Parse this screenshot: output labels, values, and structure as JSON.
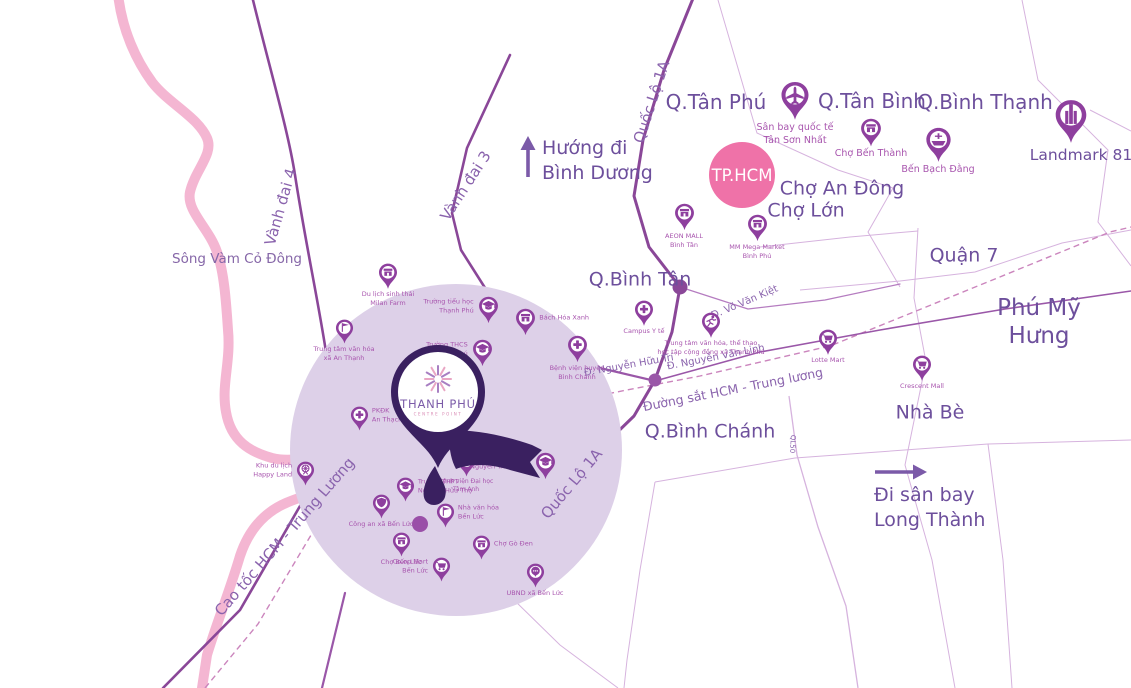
{
  "colors": {
    "road": "#8a4798",
    "road_minor": "#9a57a8",
    "boundary": "#d6b3de",
    "railway": "#cb85bd",
    "river": "#f4b6d2",
    "zone_circle": "#ddd0e8",
    "pin": "#8e3f9e",
    "dark_pin": "#3a2060",
    "hcm_pink": "#ef72a8",
    "label": "#6d4f9c",
    "road_label": "#8a63ad",
    "poi_label": "#a855ae",
    "petal_pink": "#e9a6c4",
    "petal_purple": "#a87fc2",
    "arrow": "#7b5aa8"
  },
  "project": {
    "name": "THANH PHÚ",
    "subtitle": "CENTRE POINT"
  },
  "map": {
    "city_badge": {
      "label": "TP.HCM"
    },
    "region_labels": [
      {
        "id": "q-tan-phu",
        "text": "Q.Tân Phú",
        "x": 716,
        "y": 102,
        "fs": 20
      },
      {
        "id": "q-tan-binh",
        "text": "Q.Tân Bình",
        "x": 872,
        "y": 101,
        "fs": 20
      },
      {
        "id": "q-binh-thanh",
        "text": "Q.Bình Thạnh",
        "x": 985,
        "y": 102,
        "fs": 20
      },
      {
        "id": "cho-an-dong",
        "text": "Chợ An Đông",
        "x": 842,
        "y": 189,
        "fs": 19
      },
      {
        "id": "cho-lon",
        "text": "Chợ Lớn",
        "x": 806,
        "y": 211,
        "fs": 19
      },
      {
        "id": "q-binh-tan",
        "text": "Q.Bình Tân",
        "x": 640,
        "y": 280,
        "fs": 19
      },
      {
        "id": "quan-7",
        "text": "Quận 7",
        "x": 964,
        "y": 256,
        "fs": 19
      },
      {
        "id": "phu-my-hung",
        "text": "Phú Mỹ Hưng",
        "x": 1039,
        "y": 322,
        "fs": 23
      },
      {
        "id": "nha-be",
        "text": "Nhà Bè",
        "x": 930,
        "y": 413,
        "fs": 19
      },
      {
        "id": "q-binh-chanh",
        "text": "Q.Bình Chánh",
        "x": 710,
        "y": 432,
        "fs": 19
      },
      {
        "id": "song-vam-co-dong",
        "text": "Sông Vàm Cỏ Đông",
        "x": 237,
        "y": 259,
        "fs": 13.5,
        "color": "#8667a8"
      }
    ],
    "road_labels": [
      {
        "id": "vanh-dai-4",
        "text": "Vành đai 4",
        "x": 281,
        "y": 207,
        "fs": 15,
        "rot": -74
      },
      {
        "id": "vanh-dai-3",
        "text": "Vành đai 3",
        "x": 466,
        "y": 186,
        "fs": 15,
        "rot": -57
      },
      {
        "id": "quoc-lo-1a-north",
        "text": "Quốc Lộ 1A",
        "x": 652,
        "y": 102,
        "fs": 15,
        "rot": -72
      },
      {
        "id": "quoc-lo-1a-center",
        "text": "Quốc Lộ 1A",
        "x": 572,
        "y": 484,
        "fs": 15,
        "rot": -50
      },
      {
        "id": "cao-toc-hcm-tl",
        "text": "Cao tốc HCM - Trung Lương",
        "x": 285,
        "y": 537,
        "fs": 15,
        "rot": -49
      },
      {
        "id": "d-vo-van-kiet",
        "text": "Đ. Võ Văn Kiệt",
        "x": 745,
        "y": 303,
        "fs": 10,
        "rot": -23
      },
      {
        "id": "d-nguyen-huu-tri",
        "text": "Đ. Nguyễn Hữu Trí",
        "x": 629,
        "y": 366,
        "fs": 10,
        "rot": -10
      },
      {
        "id": "d-nguyen-van-linh",
        "text": "Đ. Nguyễn Văn Linh",
        "x": 716,
        "y": 358,
        "fs": 10,
        "rot": -11
      },
      {
        "id": "duong-sat-hcm-tl",
        "text": "Đường sắt HCM - Trung lương",
        "x": 733,
        "y": 390,
        "fs": 12.5,
        "rot": -11
      },
      {
        "id": "ql50",
        "text": "QL50",
        "x": 792,
        "y": 444,
        "fs": 7,
        "rot": 93
      }
    ],
    "directions": [
      {
        "id": "huong-di-binh-duong",
        "text": "Hướng đi\nBình Dương",
        "x": 542,
        "y": 136,
        "fs": 19,
        "arrow": "up"
      },
      {
        "id": "di-san-bay-long-thanh",
        "text": "Đi sân bay\nLong Thành",
        "x": 874,
        "y": 483,
        "fs": 19,
        "arrow": "right"
      }
    ],
    "pois": [
      {
        "id": "san-bay-tan-son-nhat",
        "icon": "plane",
        "x": 795,
        "y": 95,
        "s": 30,
        "label": "Sân bay quốc tế\nTân Sơn Nhất",
        "lp": "b",
        "fs": 9.5
      },
      {
        "id": "cho-ben-thanh",
        "icon": "store",
        "x": 871,
        "y": 128,
        "s": 22,
        "label": "Chợ Bến Thành",
        "lp": "b",
        "fs": 9.5
      },
      {
        "id": "ben-bach-dang",
        "icon": "ship",
        "x": 938,
        "y": 140,
        "s": 27,
        "label": "Bến Bạch Đằng",
        "lp": "b",
        "fs": 9.5
      },
      {
        "id": "landmark-81",
        "icon": "tower",
        "x": 1071,
        "y": 115,
        "s": 34,
        "label": "Landmark 81",
        "lp": "b",
        "fs": 15.5,
        "lc": "#6d4f9c",
        "ldx": 10
      },
      {
        "id": "aeon-mall-binh-tan",
        "icon": "store",
        "x": 684,
        "y": 213,
        "s": 21,
        "label": "AEON MALL\nBình Tân",
        "lp": "b",
        "fs": 6.5
      },
      {
        "id": "mm-mega-market-binh-phu",
        "icon": "store",
        "x": 757,
        "y": 224,
        "s": 21,
        "label": "MM Mega Market\nBình Phú",
        "lp": "b",
        "fs": 6.5
      },
      {
        "id": "lotte-mart",
        "icon": "cart",
        "x": 828,
        "y": 338,
        "s": 20,
        "label": "Lotte Mart",
        "lp": "b",
        "fs": 6.5
      },
      {
        "id": "crescent-mall",
        "icon": "cart",
        "x": 922,
        "y": 364,
        "s": 20,
        "label": "Crescent Mall",
        "lp": "b",
        "fs": 6.5
      },
      {
        "id": "campus-y-te",
        "icon": "cross",
        "x": 644,
        "y": 309,
        "s": 20,
        "label": "Campus Y tế",
        "lp": "b",
        "fs": 6.5
      },
      {
        "id": "tt-vh-tt-xa-thanh-phu",
        "icon": "runner",
        "x": 711,
        "y": 321,
        "s": 20,
        "label": "Trung tâm văn hóa, thể thao\nhọc tập cộng đồng xã Thanh Phú",
        "lp": "b",
        "fs": 6.5
      },
      {
        "id": "du-lich-milan-farm",
        "icon": "store",
        "x": 388,
        "y": 272,
        "s": 20,
        "label": "Du lịch sinh thái\nMilan Farm",
        "lp": "b",
        "fs": 6.5
      },
      {
        "id": "tt-van-hoa-an-thanh",
        "icon": "flag",
        "x": 344,
        "y": 328,
        "s": 19,
        "label": "Trung tâm văn hóa\nxã An Thạnh",
        "lp": "b",
        "fs": 6.5
      },
      {
        "id": "truong-th-thanh-phu",
        "icon": "cap",
        "x": 488,
        "y": 306,
        "s": 21,
        "label": "Trường tiểu học\nThạnh Phú",
        "lp": "l",
        "fs": 6.5
      },
      {
        "id": "bach-hoa-xanh",
        "icon": "store",
        "x": 525,
        "y": 318,
        "s": 21,
        "label": "Bách Hóa Xanh",
        "lp": "r",
        "fs": 6.5
      },
      {
        "id": "truong-thcs-thanh-phu",
        "icon": "cap",
        "x": 482,
        "y": 349,
        "s": 21,
        "label": "Trường THCS\nThạnh Phú",
        "lp": "l",
        "fs": 6.5
      },
      {
        "id": "bv-huyen-binh-chanh",
        "icon": "cross",
        "x": 577,
        "y": 345,
        "s": 21,
        "label": "Bệnh viện huyện\nBình Chánh",
        "lp": "b",
        "fs": 6.5
      },
      {
        "id": "pkdk-an-thach",
        "icon": "cross",
        "x": 359,
        "y": 415,
        "s": 19,
        "label": "PKĐK\nAn Thạch",
        "lp": "r",
        "fs": 6.5
      },
      {
        "id": "khu-du-lich-happy-land",
        "icon": "park",
        "x": 305,
        "y": 470,
        "s": 19,
        "label": "Khu du lịch\nHappy Land",
        "lp": "l",
        "fs": 6.5
      },
      {
        "id": "thpt-nguyen-huu-tho",
        "icon": "cap",
        "x": 405,
        "y": 486,
        "s": 19,
        "label": "Trường THPT\nNguyễn Hữu Thọ",
        "lp": "r",
        "fs": 6.5
      },
      {
        "id": "bv-dai-hoc-tam-anh",
        "icon": "cross",
        "x": 466,
        "y": 461,
        "s": 19,
        "label": "Bệnh viện Đại học\nTâm Anh",
        "lp": "b",
        "fs": 6
      },
      {
        "id": "thpt-nguyen-trung-truc",
        "icon": "cap",
        "x": 545,
        "y": 462,
        "s": 21,
        "label": "Trường THPT\nNguyễn Trung Trực",
        "lp": "l",
        "fs": 6.5
      },
      {
        "id": "nha-van-hoa-ben-luc",
        "icon": "flag",
        "x": 445,
        "y": 512,
        "s": 19,
        "label": "Nhà văn hóa\nBến Lức",
        "lp": "r",
        "fs": 6.5
      },
      {
        "id": "cong-an-xa-ben-luc",
        "icon": "shield",
        "x": 381,
        "y": 503,
        "s": 19,
        "label": "Công an xã Bến Lức",
        "lp": "b",
        "fs": 6.5
      },
      {
        "id": "cho-ben-luc",
        "icon": "store",
        "x": 401,
        "y": 541,
        "s": 19,
        "label": "Chợ Bến Lức",
        "lp": "b",
        "fs": 6.5
      },
      {
        "id": "coop-mart-ben-luc",
        "icon": "cart",
        "x": 441,
        "y": 566,
        "s": 19,
        "label": "Co.op Mart\nBến Lức",
        "lp": "l",
        "fs": 6.5
      },
      {
        "id": "cho-go-den",
        "icon": "store",
        "x": 481,
        "y": 544,
        "s": 19,
        "label": "Chợ Gò Đen",
        "lp": "r",
        "fs": 6.5
      },
      {
        "id": "ubnd-xa-ben-luc",
        "icon": "chat",
        "x": 535,
        "y": 572,
        "s": 19,
        "label": "UBND xã Bến Lức",
        "lp": "b",
        "fs": 6.5
      }
    ]
  }
}
